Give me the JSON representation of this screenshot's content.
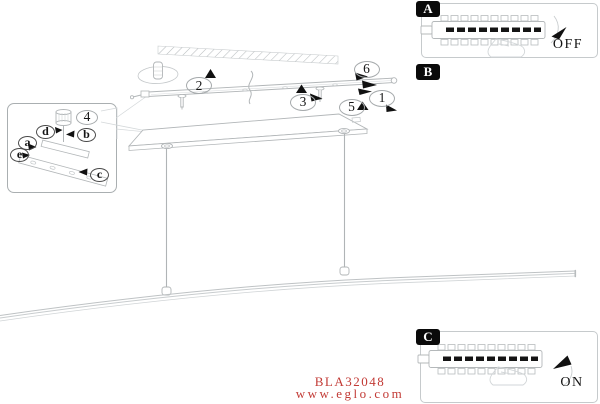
{
  "footer": {
    "product_code": "BLA32048",
    "website": "www.eglo.com",
    "text_color": "#c23a35"
  },
  "panels": {
    "a": {
      "label": "A",
      "state": "OFF"
    },
    "b": {
      "label": "B"
    },
    "c": {
      "label": "C",
      "state": "ON"
    }
  },
  "parts": {
    "p1": "1",
    "p2": "2",
    "p3": "3",
    "p4": "4",
    "p5": "5",
    "p6": "6"
  },
  "inset_parts": {
    "a": "a",
    "b": "b",
    "c": "c",
    "d": "d",
    "e": "e"
  },
  "colors": {
    "line": "#b4b8ba",
    "line_faint": "#d4d8da",
    "arrow_black": "#111111",
    "accent_red": "#c23a35"
  }
}
